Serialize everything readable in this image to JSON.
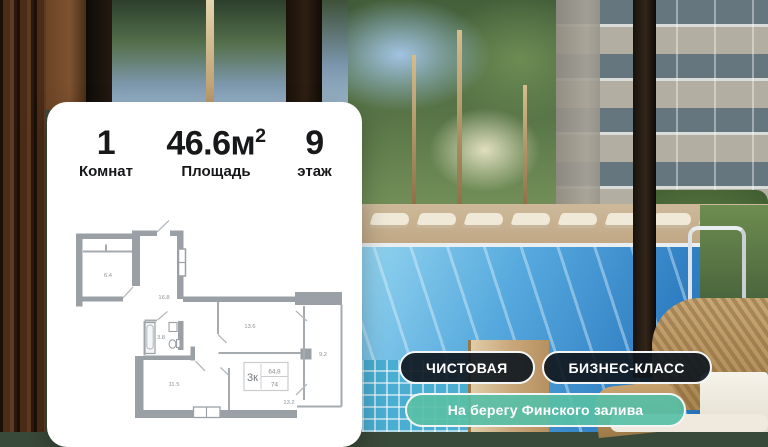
{
  "card": {
    "stats": [
      {
        "num": "1",
        "sup": "",
        "label": "Комнат"
      },
      {
        "num": "46.6м",
        "sup": "2",
        "label": "Площадь"
      },
      {
        "num": "9",
        "sup": "",
        "label": "этаж"
      }
    ]
  },
  "floorplan": {
    "rooms": {
      "balcony_left": "6.4",
      "kitchen_living": "16.8",
      "bathroom": "3.8",
      "room_bottom_left": "11.5",
      "room_right": "13.6",
      "balcony_right": "9.2",
      "hall": "13.2"
    },
    "stamp": {
      "code": "3к",
      "area_top": "64,8",
      "area_bottom": "74"
    }
  },
  "badges": {
    "finish": "ЧИСТОВАЯ",
    "class": "БИЗНЕС-КЛАСС",
    "location": "На берегу Финского залива"
  },
  "colors": {
    "badge_dark": "rgba(16,24,31,0.92)",
    "badge_teal": "rgba(88,191,166,0.92)",
    "plan_walls": "#9aa0a5"
  }
}
